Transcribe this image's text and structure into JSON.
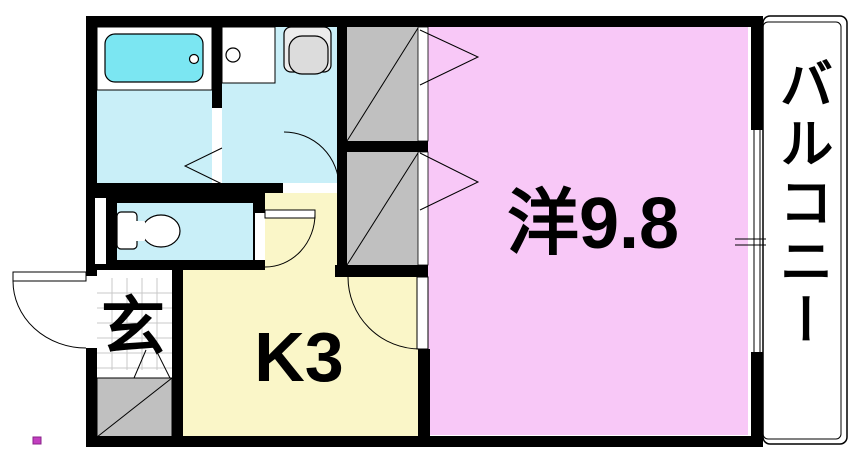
{
  "diagram": {
    "kind": "apartment-floor-plan",
    "rooms": {
      "western_room": {
        "label": "洋9.8"
      },
      "kitchen": {
        "label": "K3"
      },
      "entrance": {
        "label": "玄"
      },
      "balcony": {
        "label": "バルコニー"
      }
    },
    "fixtures": [
      "bathtub-icon",
      "washing-machine-pan-icon",
      "washbasin-icon",
      "toilet-icon",
      "closet-icon",
      "shoe-cabinet-icon",
      "window-icon",
      "door-swing-icon",
      "folding-door-icon"
    ]
  },
  "colors": {
    "wall": "#000000",
    "wet_floor": "#c9eff8",
    "bathtub": "#7be6f2",
    "kitchen_floor": "#faf6c8",
    "room_floor": "#f8c8f7",
    "closet": "#c0c0c0",
    "basin": "#dcdcdc",
    "grid": "#c9c9c9",
    "dot": "#c23ec0"
  }
}
